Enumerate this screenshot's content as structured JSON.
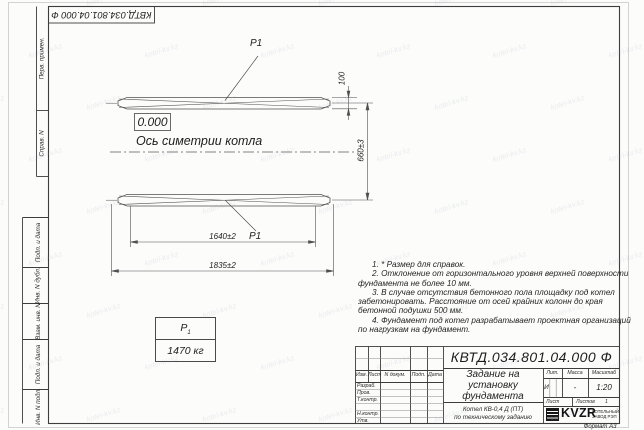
{
  "watermark": {
    "text": "kotel-kv.kz"
  },
  "stamp_rotated": "КВТД.034.801.04.000  Ф",
  "margin_labels": {
    "top": [
      "Перв. примен.",
      "Справ. N"
    ],
    "bottom": [
      "Подп. и дата",
      "Инв. N дубл.",
      "Взам. инв. N",
      "Подп. и дата",
      "Инв. N подл."
    ]
  },
  "drawing": {
    "p1_top": "P1",
    "p1_bottom": "P1",
    "elevation": "0.000",
    "axis_label": "Ось симетрии котла",
    "dims": {
      "height": "100",
      "spacing": "660±3",
      "inner": "1640±2",
      "outer": "1835±2"
    },
    "load_table": {
      "symbol": "Р",
      "symbol_sub": "1",
      "value": "1470 кг"
    }
  },
  "notes": [
    "1. * Размер для справок.",
    "2. Отклонение от горизонтального уровня верхней поверхности фундамента не более 10 мм.",
    "3. В случае отсутствия бетонного пола площадку под котел забетонировать. Расстояние от осей крайних колонн до края бетонной подушки 500 мм.",
    "4. Фундамент под котел разрабатывает проектная организаций по нагрузкам на фундамент."
  ],
  "title_block": {
    "doc_number": "КВТД.034.801.04.000  Ф",
    "title_lines": [
      "Задание на",
      "установку",
      "фундамента"
    ],
    "subtitle_lines": [
      "Котел  КВ-0,4  Д  (ПТ)",
      "по техническому заданию"
    ],
    "header_cols": [
      "Изм.",
      "Лист",
      "N докум.",
      "Подп.",
      "Дата"
    ],
    "row_labels": [
      "Разраб.",
      "Пров.",
      "Т.контр.",
      "",
      "Н.контр.",
      "Утв."
    ],
    "lit": {
      "label": "Лит.",
      "value": "И"
    },
    "mass": {
      "label": "Масса",
      "value": "-"
    },
    "scale": {
      "label": "Масштаб",
      "value": "1:20"
    },
    "sheet": {
      "label": "Лист",
      "sheets_label": "Листов",
      "sheets_value": "1"
    },
    "logo": {
      "text": "KVZR",
      "sub_lines": [
        "КОТЕЛЬНЫЙ",
        "ЗАВОД РЭП"
      ]
    },
    "format": "Формат А3"
  }
}
